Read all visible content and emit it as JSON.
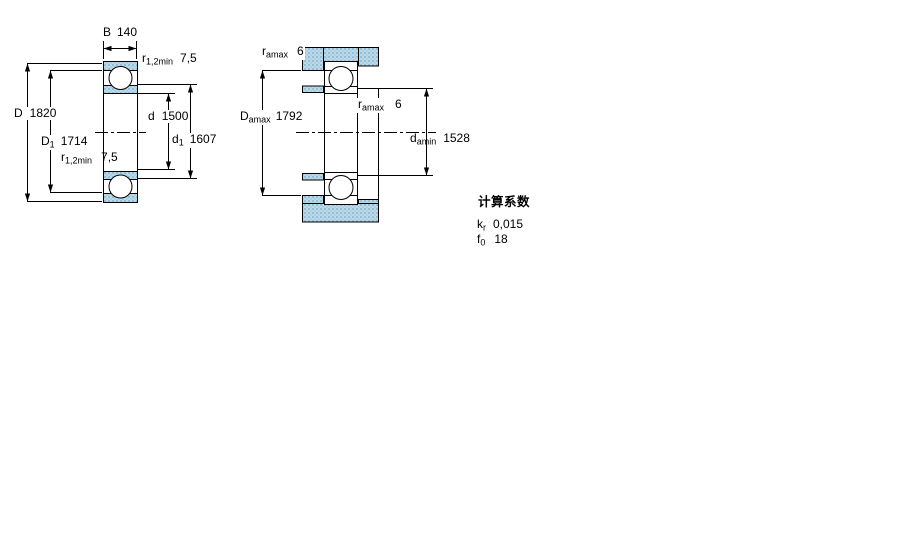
{
  "left_drawing": {
    "width_dim": {
      "name": "B",
      "value": "140"
    },
    "r_top": {
      "name": "r",
      "sub": "1,2min",
      "value": "7,5"
    },
    "outer_diameter": {
      "name": "D",
      "value": "1820"
    },
    "shoulder_d1": {
      "name": "D",
      "sub": "1",
      "value": "1714"
    },
    "r_bottom": {
      "name": "r",
      "sub": "1,2min",
      "value": "7,5"
    },
    "bore_diameter": {
      "name": "d",
      "value": "1500"
    },
    "inner_d1": {
      "name": "d",
      "sub": "1",
      "value": "1607"
    }
  },
  "right_drawing": {
    "r_amax_top": {
      "name": "r",
      "sub": "amax",
      "value": "6"
    },
    "housing_abutment": {
      "name": "D",
      "sub": "amax",
      "value": "1792"
    },
    "r_amax_mid": {
      "name": "r",
      "sub": "amax",
      "value": "6"
    },
    "shaft_abutment": {
      "name": "d",
      "sub": "amin",
      "value": "1528"
    }
  },
  "calculation_factors": {
    "heading": "计算系数",
    "kr": {
      "name": "k",
      "sub": "r",
      "value": "0,015"
    },
    "f0": {
      "name": "f",
      "sub": "0",
      "value": "18"
    }
  },
  "colors": {
    "hatch_fill": "#badae9",
    "hatch_dot": "#7aa9c6",
    "hatch_dot2": "#a6c8dc",
    "line_color": "#000000"
  }
}
